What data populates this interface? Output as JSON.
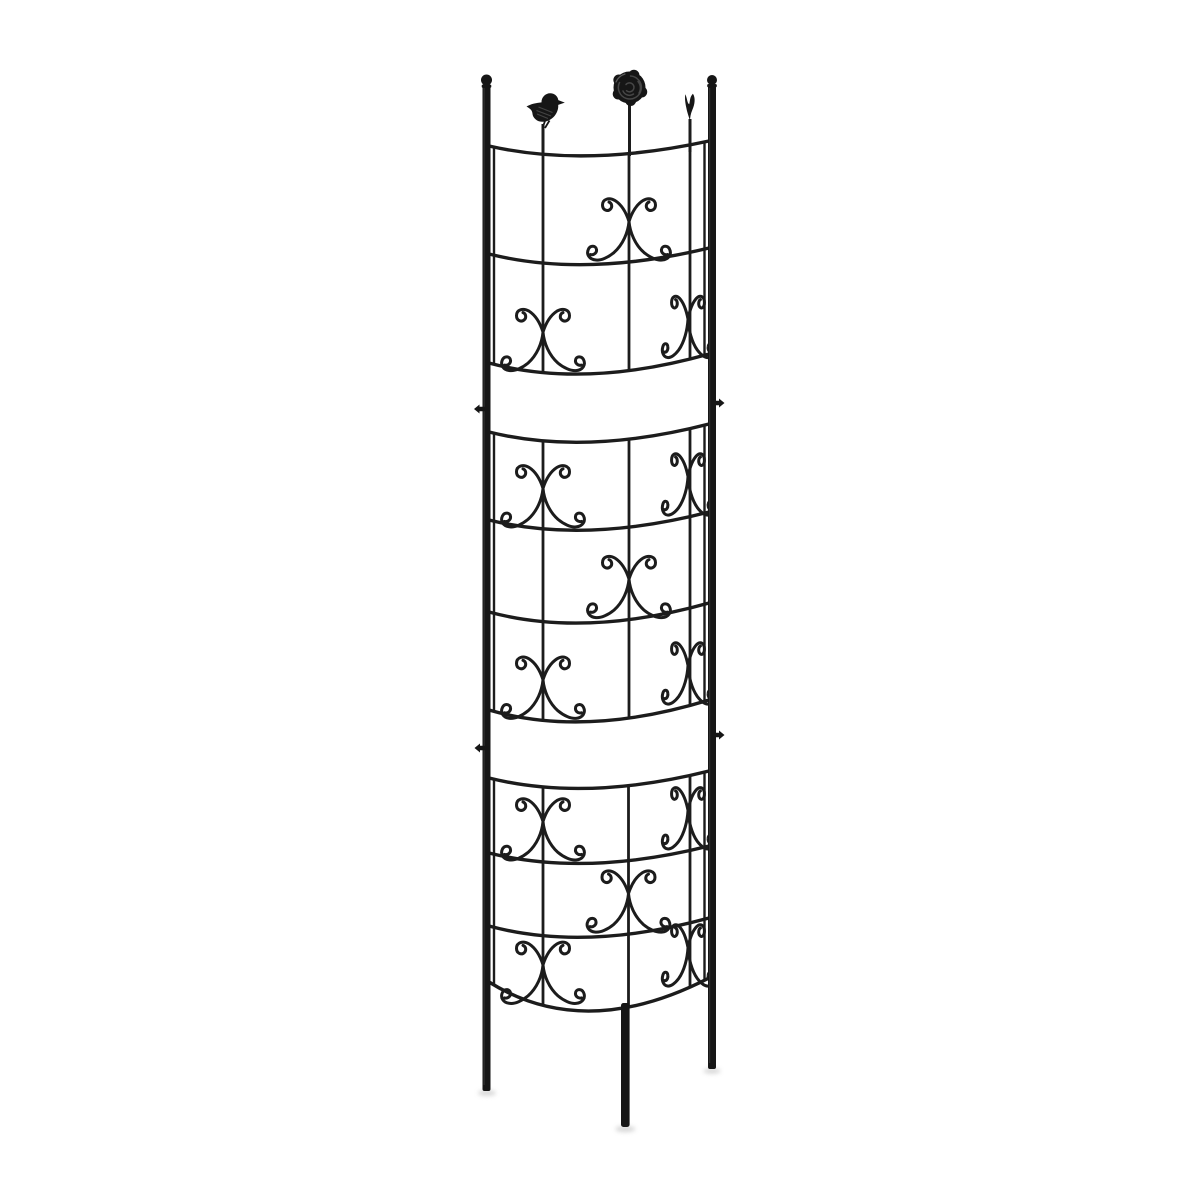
{
  "image": {
    "width": 1200,
    "height": 1200,
    "subject": "black half-round metal garden trellis plant support with two bird finials and one rose finial, standing on three stake legs",
    "background_color": "#ffffff"
  },
  "colors": {
    "background": "#ffffff",
    "metal": "#161616",
    "wire": "#1c1c1c",
    "detail_sheen": "#4f4f4f",
    "highlight": "#7a7a7a",
    "shadow": "#b9b9b9"
  },
  "trellis": {
    "attach": {
      "left_x": 489,
      "right_x": 709,
      "ctrl_x": 585
    },
    "posts": {
      "left": {
        "x": 486.5,
        "width": 8,
        "top": 84,
        "bottom": 1091,
        "ball_cy": 80,
        "ball_r": 5.5
      },
      "right": {
        "x": 712.0,
        "width": 8,
        "top": 84,
        "bottom": 1069,
        "ball_cy": 80,
        "ball_r": 5.0
      }
    },
    "center_leg": {
      "x": 625.3,
      "width": 8.6,
      "top": 1003,
      "bottom": 1127
    },
    "stems": [
      {
        "x": 543.0,
        "y1": 124,
        "y2": 154,
        "finial": "bird-left"
      },
      {
        "x": 629.5,
        "y1": 102,
        "y2": 156,
        "finial": "rose"
      },
      {
        "x": 690.0,
        "y1": 119,
        "y2": 152,
        "finial": "bird-right"
      }
    ],
    "finials": {
      "bird_left": {
        "cx": 545,
        "cy": 108
      },
      "rose": {
        "cx": 629.5,
        "cy": 87.5,
        "r": 16
      },
      "bird_right": {
        "cx": 690,
        "cy": 107
      }
    },
    "sections": [
      {
        "bars": [
          {
            "yl": 146,
            "yr": 141,
            "dip": 11
          },
          {
            "yl": 254,
            "yr": 248,
            "dip": 12
          },
          {
            "yl": 363,
            "yr": 354,
            "dip": 13
          }
        ],
        "verticals": [
          543,
          629,
          690
        ],
        "edge_wires": [
          494,
          704.5
        ],
        "motifs": [
          {
            "cx": 629,
            "below": 1,
            "sx": 1
          },
          {
            "cx": 543,
            "below": 2,
            "sx": 1
          },
          {
            "cx": 688,
            "below": 2,
            "sx": 0.62
          }
        ]
      },
      {
        "bars": [
          {
            "yl": 432,
            "yr": 424,
            "dip": 12
          },
          {
            "yl": 520,
            "yr": 512,
            "dip": 12
          },
          {
            "yl": 612,
            "yr": 603,
            "dip": 13
          },
          {
            "yl": 710,
            "yr": 700,
            "dip": 14
          }
        ],
        "verticals": [
          543,
          629,
          690
        ],
        "edge_wires": [
          494,
          704.5
        ],
        "motifs": [
          {
            "cx": 543,
            "below": 1,
            "sx": 1
          },
          {
            "cx": 688,
            "below": 1,
            "sx": 0.62
          },
          {
            "cx": 629,
            "below": 2,
            "sx": 1
          },
          {
            "cx": 543,
            "below": 3,
            "sx": 1
          },
          {
            "cx": 688,
            "below": 3,
            "sx": 0.62
          }
        ]
      },
      {
        "bars": [
          {
            "yl": 778,
            "yr": 771,
            "dip": 12
          },
          {
            "yl": 853,
            "yr": 846,
            "dip": 12
          },
          {
            "yl": 926,
            "yr": 918,
            "dip": 13
          },
          {
            "yl": 982,
            "yr": 978,
            "dip": 30
          }
        ],
        "verticals": [
          543,
          628.5,
          690
        ],
        "edge_wires": [
          494,
          704.5
        ],
        "motifs": [
          {
            "cx": 543,
            "below": 1,
            "sx": 1
          },
          {
            "cx": 688,
            "below": 1,
            "sx": 0.62
          },
          {
            "cx": 628.5,
            "below": 2,
            "sx": 1
          },
          {
            "cx": 543,
            "below": 3,
            "sx": 1
          },
          {
            "cx": 688,
            "below": 3,
            "sx": 0.62
          }
        ]
      }
    ],
    "clips": [
      {
        "side": "left",
        "x": 486.5,
        "y": 409
      },
      {
        "side": "right",
        "x": 712.0,
        "y": 403
      },
      {
        "side": "left",
        "x": 487.0,
        "y": 748
      },
      {
        "side": "right",
        "x": 712.0,
        "y": 735
      }
    ],
    "shadows": [
      {
        "cx": 487,
        "cy": 1093,
        "rx": 9,
        "ry": 3
      },
      {
        "cx": 625.3,
        "cy": 1129,
        "rx": 10,
        "ry": 3.2
      },
      {
        "cx": 712,
        "cy": 1071,
        "rx": 8.5,
        "ry": 2.8
      }
    ]
  }
}
